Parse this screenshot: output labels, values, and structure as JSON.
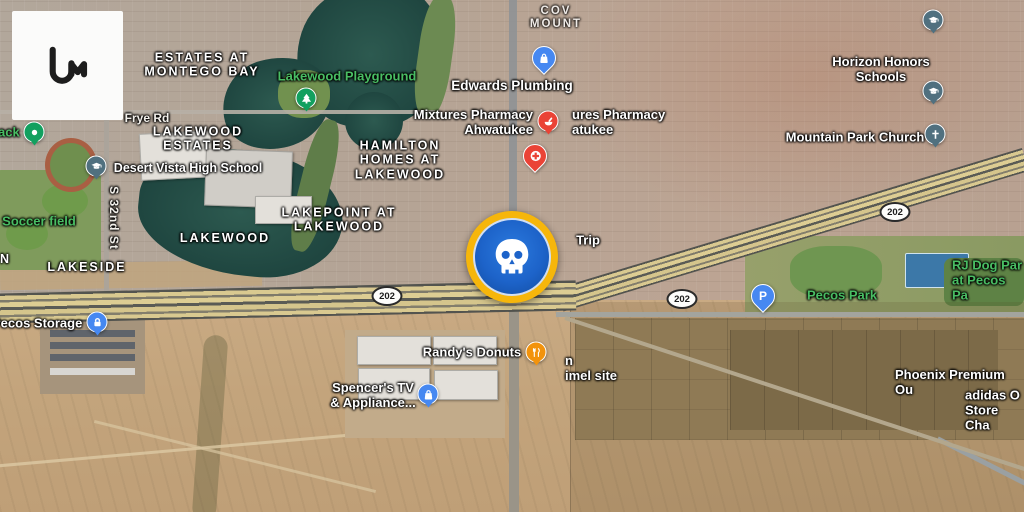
{
  "app": {
    "name": "Liveuamap satellite map",
    "logo_glyph": "uM"
  },
  "marker": {
    "icon": "skull-icon",
    "ring_color": "#F6B60B",
    "fill_color": "#1D63C9"
  },
  "shield": {
    "route": "202"
  },
  "icons": {
    "parking_glyph": "P"
  },
  "colors": {
    "park_label_green": "#49bd63",
    "poi_blue": "#4688f1",
    "poi_red": "#ea4336",
    "poi_orange": "#f2930d",
    "poi_green": "#12a05f",
    "poi_slate": "#50707f"
  },
  "labels": {
    "neighborhoods": [
      {
        "id": "estates-at-montego-bay",
        "text": "ESTATES AT\nMONTEGO BAY"
      },
      {
        "id": "lakewood-estates",
        "text": "LAKEWOOD\nESTATES"
      },
      {
        "id": "hamilton-homes-at-lakewood",
        "text": "HAMILTON\nHOMES AT\nLAKEWOOD"
      },
      {
        "id": "lakepoint-at-lakewood",
        "text": "LAKEPOINT AT\nLAKEWOOD"
      },
      {
        "id": "lakewood",
        "text": "LAKEWOOD"
      },
      {
        "id": "lakeside",
        "text": "LAKESIDE"
      },
      {
        "id": "cove-mountain-partial",
        "text": "COV\nMOUNT"
      },
      {
        "id": "edge-fragment-n",
        "text": "N"
      }
    ],
    "streets": [
      {
        "id": "frye-rd",
        "text": "Frye Rd"
      },
      {
        "id": "s-32nd-st",
        "text": "S 32nd St"
      }
    ],
    "parks": [
      {
        "id": "track-partial",
        "text": "ack"
      },
      {
        "id": "lakewood-playground",
        "text": "Lakewood Playground"
      },
      {
        "id": "soccer-field",
        "text": "Soccer field"
      },
      {
        "id": "pecos-park",
        "text": "Pecos Park"
      },
      {
        "id": "rj-dog-park",
        "text": "RJ Dog Par\nat Pecos Pa"
      }
    ],
    "pois": [
      {
        "id": "edwards-plumbing",
        "text": "Edwards Plumbing"
      },
      {
        "id": "mixtures-pharmacy",
        "text": "Mixtures Pharmacy\nAhwatukee"
      },
      {
        "id": "mixtures-pharmacy-duplicate",
        "text": "ures Pharmacy\natukee"
      },
      {
        "id": "quiktrip-partial",
        "text": "Trip"
      },
      {
        "id": "desert-vista-high-school",
        "text": "Desert Vista High School"
      },
      {
        "id": "horizon-honors-schools",
        "text": "Horizon Honors Schools"
      },
      {
        "id": "mountain-park-church",
        "text": "Mountain Park Church"
      },
      {
        "id": "pecos-storage",
        "text": "Pecos Storage"
      },
      {
        "id": "randys-donuts",
        "text": "Randy's Donuts"
      },
      {
        "id": "spencers-tv-appliance",
        "text": "Spencer's TV\n& Appliance..."
      },
      {
        "id": "kimel-site-partial",
        "text": "n\nimel site"
      },
      {
        "id": "phoenix-premium-outlets-partial",
        "text": "Phoenix Premium Ou"
      },
      {
        "id": "adidas-outlet-partial",
        "text": "adidas O\nStore Cha"
      }
    ]
  }
}
